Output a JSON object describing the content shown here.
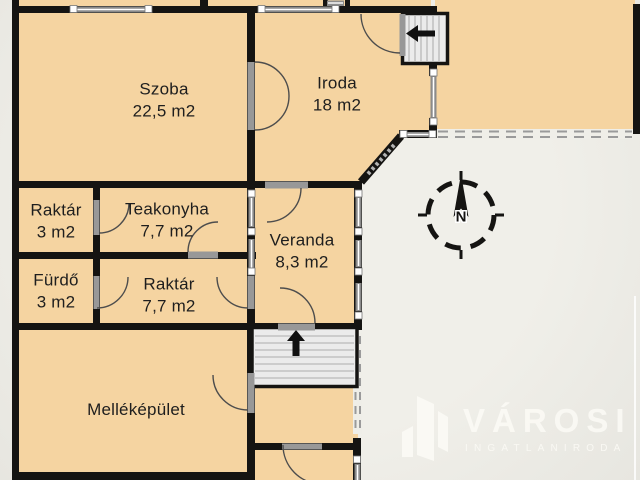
{
  "plan": {
    "rooms": [
      {
        "id": "szoba",
        "name": "Szoba",
        "area": "22,5 m2"
      },
      {
        "id": "iroda",
        "name": "Iroda",
        "area": "18 m2"
      },
      {
        "id": "raktar-small",
        "name": "Raktár",
        "area": "3 m2"
      },
      {
        "id": "teakonyha",
        "name": "Teakonyha",
        "area": "7,7 m2"
      },
      {
        "id": "veranda",
        "name": "Veranda",
        "area": "8,3 m2"
      },
      {
        "id": "furdo",
        "name": "Fürdő",
        "area": "3 m2"
      },
      {
        "id": "raktar-large",
        "name": "Raktár",
        "area": "7,7 m2"
      },
      {
        "id": "mellekepulet",
        "name": "Melléképület",
        "area": ""
      }
    ],
    "compass": {
      "north_label": "N"
    },
    "stairs": [
      {
        "id": "upper-stair",
        "arrow": "left"
      },
      {
        "id": "lower-stair",
        "arrow": "up"
      }
    ]
  },
  "watermark": {
    "brand": "VÁROSI",
    "tagline": "INGATLANIRODA"
  },
  "colors": {
    "room_fill": "#f5d4a1",
    "wall": "#151412",
    "background": "#ecebe5",
    "watermark_white": "#fbfaf5"
  }
}
